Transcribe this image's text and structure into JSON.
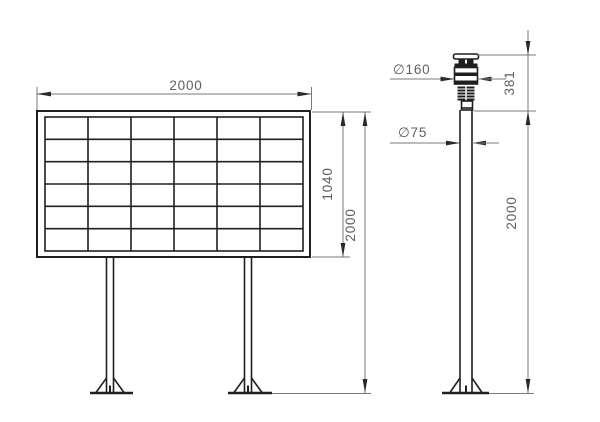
{
  "front_view": {
    "width_dim": "2000",
    "panel_height_dim": "1040",
    "overall_height_dim": "2000",
    "grid_rows": 6,
    "grid_cols": 6,
    "grid_box": {
      "x": 45,
      "y": 117,
      "w": 258,
      "h": 134
    }
  },
  "side_view": {
    "head_diameter_dim": "∅160",
    "pole_diameter_dim": "∅75",
    "head_height_dim": "381",
    "pole_height_dim": "2000"
  },
  "colors": {
    "line": "#1f1f1f",
    "dim": "#7a7a7a",
    "arrow": "#2a2a2a",
    "text": "#5f5f5f",
    "bg": "#ffffff"
  }
}
